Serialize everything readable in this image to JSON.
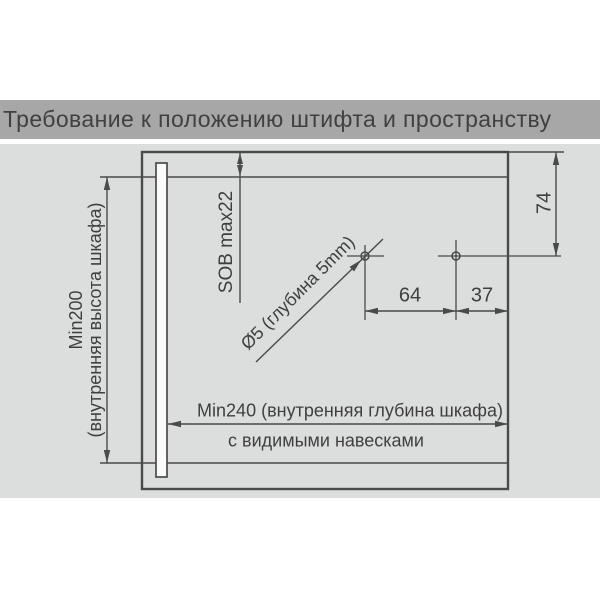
{
  "title": "Требование к положению штифта и пространству",
  "diagram": {
    "labels": {
      "cabinet_height_line1": "Min200",
      "cabinet_height_line2": "(внутренняя высота шкафа)",
      "top_panel_thickness": "SOB max22",
      "pin_distance_from_top": "74",
      "hole_spec": "Ø5 (глубина 5mm)",
      "pin_spacing": "64",
      "pin_to_back_edge": "37",
      "cabinet_depth": "Min240 (внутренняя глубина шкафа)",
      "mounting_note": "с видимыми навесками"
    },
    "colors": {
      "title_bar_bg": "#a7a7a7",
      "panel_bg": "#dcdddd",
      "line": "#4a4a4a",
      "text": "#3f3f3f",
      "strip_fill": "#fafafa"
    }
  }
}
